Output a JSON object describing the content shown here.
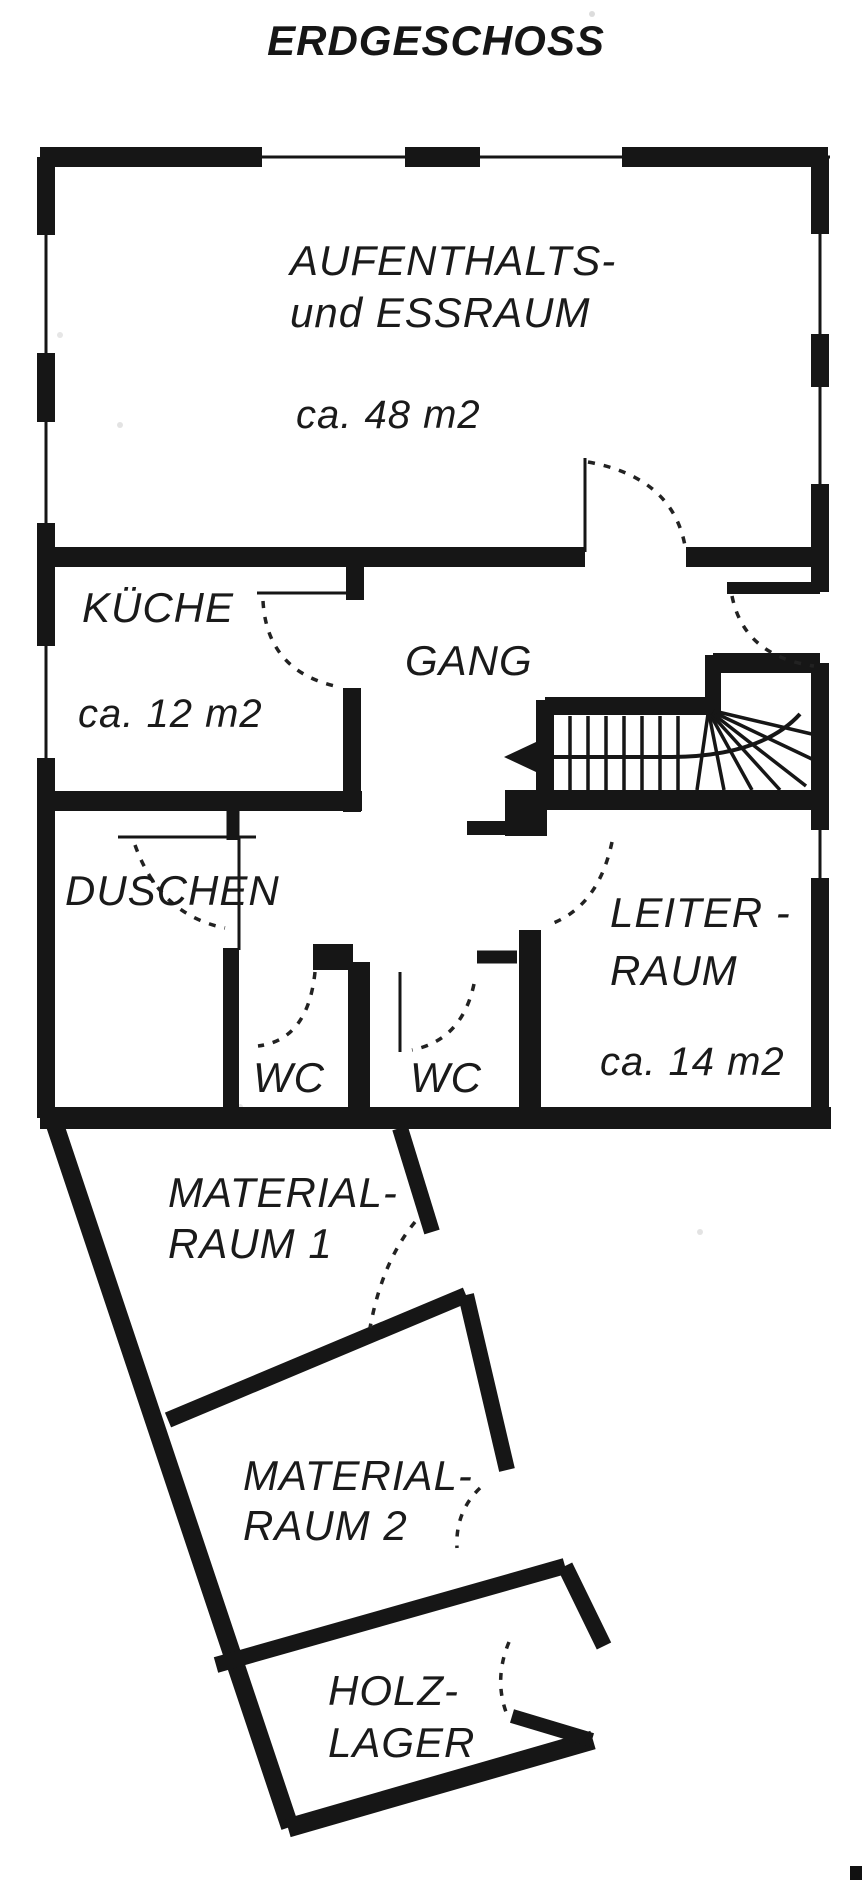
{
  "title": "ERDGESCHOSS",
  "floor_plan": {
    "rooms": [
      {
        "id": "aufenthaltsraum",
        "name_line1": "AUFENTHALTS-",
        "name_line2": "und ESSRAUM",
        "area": "ca. 48 m2"
      },
      {
        "id": "kueche",
        "name": "KÜCHE",
        "area": "ca. 12 m2"
      },
      {
        "id": "gang",
        "name": "GANG"
      },
      {
        "id": "duschen",
        "name": "DUSCHEN"
      },
      {
        "id": "wc-1",
        "name": "WC"
      },
      {
        "id": "wc-2",
        "name": "WC"
      },
      {
        "id": "leiterraum",
        "name_line1": "LEITER -",
        "name_line2": "RAUM",
        "area": "ca. 14 m2"
      },
      {
        "id": "materialraum-1",
        "name_line1": "MATERIAL-",
        "name_line2": "RAUM 1"
      },
      {
        "id": "materialraum-2",
        "name_line1": "MATERIAL-",
        "name_line2": "RAUM 2"
      },
      {
        "id": "holzlager",
        "name_line1": "HOLZ-",
        "name_line2": "LAGER"
      }
    ],
    "colors": {
      "ink": "#161616",
      "paper": "#ffffff"
    }
  }
}
